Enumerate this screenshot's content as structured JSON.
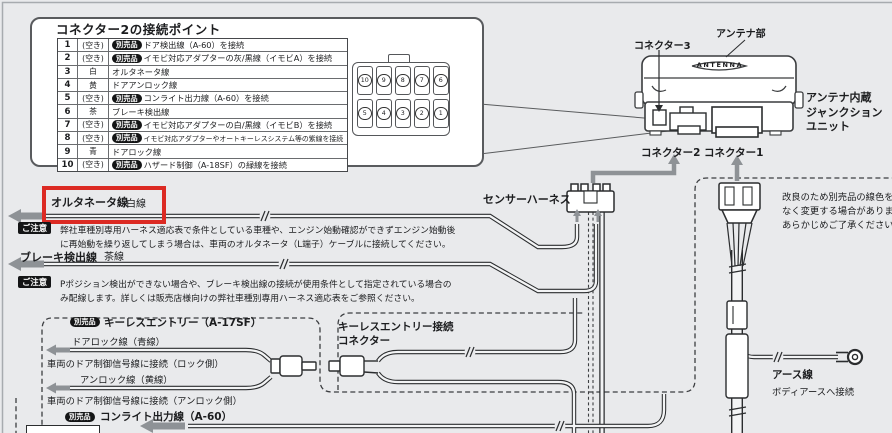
{
  "colors": {
    "highlight_red": "#dc2a23",
    "badge_black": "#141516",
    "arrow_gray": "#8e9296",
    "page_bg": "#e9eaec"
  },
  "connector_table": {
    "title": "コネクター2の接続ポイント",
    "rows": [
      {
        "num": "1",
        "color": "(空き)",
        "badge": "別売品",
        "desc": "ドア検出線（A-60）を接続"
      },
      {
        "num": "2",
        "color": "(空き)",
        "badge": "別売品",
        "desc": "イモビ対応アダプターの灰/黒線（イモビA）を接続"
      },
      {
        "num": "3",
        "color": "白",
        "badge": "",
        "desc": "オルタネータ線"
      },
      {
        "num": "4",
        "color": "黄",
        "badge": "",
        "desc": "ドアアンロック線"
      },
      {
        "num": "5",
        "color": "(空き)",
        "badge": "別売品",
        "desc": "コンライト出力線（A-60）を接続"
      },
      {
        "num": "6",
        "color": "茶",
        "badge": "",
        "desc": "ブレーキ検出線"
      },
      {
        "num": "7",
        "color": "(空き)",
        "badge": "別売品",
        "desc": "イモビ対応アダプターの白/黒線（イモビB）を接続"
      },
      {
        "num": "8",
        "color": "(空き)",
        "badge": "別売品",
        "desc": "イモビ対応アダプターやオートキーレスシステム等の紫線を接続"
      },
      {
        "num": "9",
        "color": "青",
        "badge": "",
        "desc": "ドアロック線"
      },
      {
        "num": "10",
        "color": "(空き)",
        "badge": "別売品",
        "desc": "ハザード制御（A-18SF）の緑線を接続"
      }
    ],
    "pins": {
      "row1": [
        "10",
        "9",
        "8",
        "7",
        "6"
      ],
      "row2": [
        "5",
        "4",
        "3",
        "2",
        "1"
      ]
    }
  },
  "unit": {
    "antenna_text": "ANTENNA",
    "connector3_label": "コネクター3",
    "antenna_part_label": "アンテナ部",
    "name_line1": "アンテナ内蔵",
    "name_line2": "ジャンクション",
    "name_line3": "ユニット",
    "connector2_label": "コネクター2",
    "connector1_label": "コネクター1"
  },
  "labels": {
    "sensor_harness": "センサーハーネス"
  },
  "alternator": {
    "name": "オルタネータ線",
    "color": "白線"
  },
  "brake": {
    "name": "ブレーキ検出線",
    "color": "茶線"
  },
  "notes": {
    "badge": "ご注意",
    "note1_line1": "弊社車種別専用ハーネス適応表で条件としている車種や、エンジン始動確認ができずエンジン始動後",
    "note1_line2": "に再始動を繰り返してしまう場合は、車両のオルタネータ（L端子）ケーブルに接続してください。",
    "note2_line1": "Pポジション検出ができない場合や、ブレーキ検出線の接続が使用条件として指定されている場合の",
    "note2_line2": "み配線します。詳しくは販売店様向けの弊社車種別専用ハーネス適応表をご参照ください。"
  },
  "right_note": {
    "line1": "改良のため別売品の線色を予告",
    "line2": "なく変更する場合があります。",
    "line3": "あらかじめご了承ください。"
  },
  "keyless": {
    "badge": "別売品",
    "title": "キーレスエントリー（A-17SF）",
    "lock_line": "ドアロック線（青線）",
    "lock_connect": "車両のドア制御信号線に接続（ロック側）",
    "unlock_line": "アンロック線（黄線）",
    "unlock_connect": "車両のドア制御信号線に接続（アンロック側）"
  },
  "keyless_connector": {
    "line1": "キーレスエントリー接続",
    "line2": "コネクター"
  },
  "conlight": {
    "badge": "別売品",
    "label": "コンライト出力線（A-60）"
  },
  "ground": {
    "name": "アース線",
    "desc": "ボディアースへ接続"
  }
}
